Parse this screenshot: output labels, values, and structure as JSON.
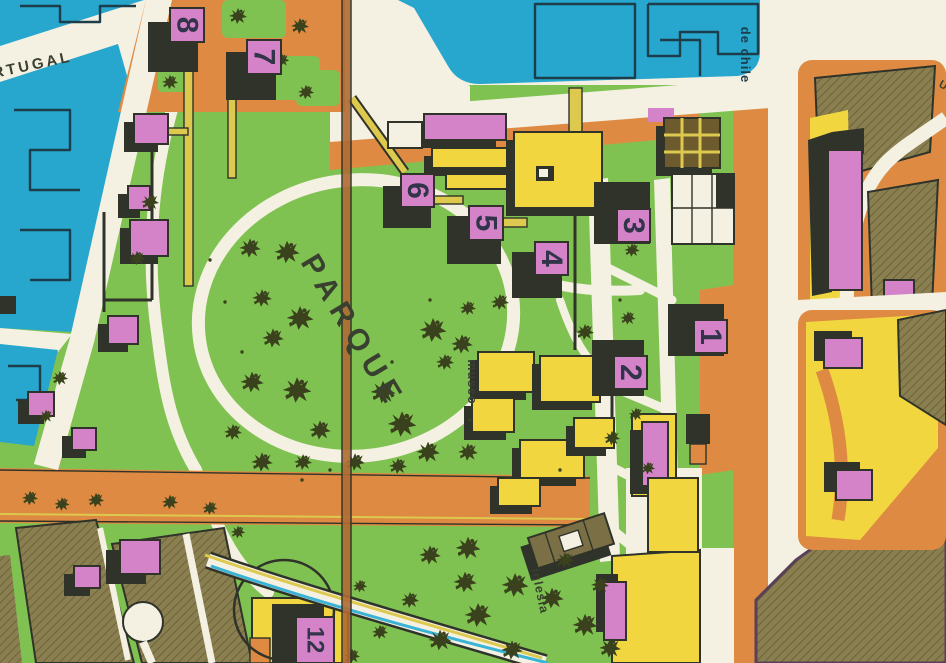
{
  "map": {
    "labels": {
      "street_portugal": "RTUGAL",
      "street_de_chile": "de chile",
      "park": "PARQUE",
      "museum": "museo",
      "church": "iglesia",
      "street_partial": "U"
    },
    "markers": [
      {
        "label": "1"
      },
      {
        "label": "2"
      },
      {
        "label": "3"
      },
      {
        "label": "4"
      },
      {
        "label": "5"
      },
      {
        "label": "6"
      },
      {
        "label": "7"
      },
      {
        "label": "8"
      },
      {
        "label": "12"
      }
    ],
    "palette": {
      "background": "#efece0",
      "water": "#27a6ce",
      "water_line": "#1d3d4b",
      "park": "#80c251",
      "orange": "#de8a42",
      "yellow": "#f1d640",
      "path_yellow": "#ddc94e",
      "pink": "#d583c8",
      "olive": "#8a7f50",
      "olive_line": "#6e6336",
      "brown": "#6e5b2d",
      "church": "#7b7045",
      "cream": "#f4f1e2",
      "ink": "#2f332a",
      "tree": "#3a421d",
      "digit": "#32344a",
      "stripe_cyan": "#3ab3d6",
      "label": "#39402f",
      "purple_edge": "#584058"
    }
  }
}
